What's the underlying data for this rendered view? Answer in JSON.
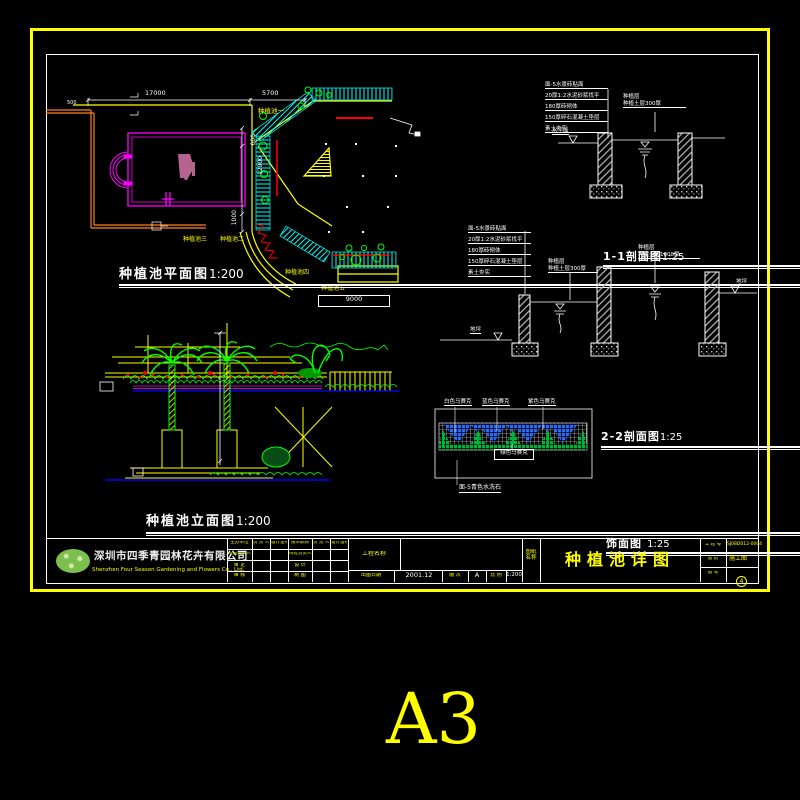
{
  "paper_size": "A3",
  "sheet": {
    "plan": {
      "title": "种植池平面图",
      "scale": "1:200",
      "dim_17000": "17000",
      "dim_5700": "5700",
      "dim_500": "500",
      "dim_600": "600",
      "dim_12900": "12900",
      "dim_1000": "1000",
      "dim_9000": "9000",
      "pool1": "种植池一",
      "pool2": "种植池二",
      "pool3": "种植池三",
      "pool4": "种植池四",
      "pool5": "种植池五"
    },
    "elevation": {
      "title": "种植池立面图",
      "scale": "1:200"
    },
    "section11": {
      "title": "1-1剖面图",
      "scale": "1:25",
      "callout1": "面-5水景砖贴面",
      "callout2": "20厚1:2水泥砂浆找平",
      "callout3": "180厚砖砌体",
      "callout4": "150厚碎石混凝土垫层",
      "callout5": "素土夯实",
      "soil_label1": "种植层",
      "soil_label2": "种植土层300厚",
      "level_label": "水平面"
    },
    "section22": {
      "title": "2-2剖面图",
      "scale": "1:25",
      "callout1": "面-5水景砖贴面",
      "callout2": "20厚1:2水泥砂浆找平",
      "callout3": "180厚砖砌体",
      "callout4": "150厚碎石混凝土垫层",
      "callout5": "素土夯实",
      "soil1_label1": "种植层",
      "soil1_label2": "种植土层300厚",
      "soil2_label1": "种植层",
      "soil2_label2": "种植土层1000厚",
      "ground_right": "地坪",
      "ground_left": "地坪"
    },
    "facing": {
      "title": "饰面图",
      "scale": "1:25",
      "mosaic_white": "白色马赛克",
      "mosaic_blue": "蓝色马赛克",
      "mosaic_purple": "紫色马赛克",
      "mosaic_green": "绿色马赛克",
      "base": "面-5青色水洗石"
    }
  },
  "titleblock": {
    "company_cn": "深圳市四季青园林花卉有限公司",
    "company_en": "Shenzhen Four Season Gardening and Flowers Co., Ltd.",
    "h_unit": "主办单位",
    "h_person": "负 责 人",
    "h_cert": "设计证号",
    "h_tech": "技术职称",
    "h_person2": "负 责 人",
    "h_cert2": "设计证号",
    "r2c1": "项目负责人",
    "r2c4": "绿化负责人",
    "r3c1": "审 定",
    "r3c4": "设 计",
    "r4c1": "审 核",
    "r4c4": "制 图",
    "project_name_label": "工程名称",
    "date_label": "出图日期",
    "date_value": "2001.12",
    "rev_label": "版 次",
    "rev_value": "A",
    "scale_label": "比 例",
    "scale_value": "1:200",
    "sheet_name_label": "图纸名称",
    "sheet_name": "种植池详图",
    "pno_label": "工 程 号",
    "pno_value": "SJ08D012-0004",
    "type_label": "图 别",
    "type_value": "施工图",
    "no_label": "图 号",
    "no_value": "4"
  },
  "colors": {
    "accent": "#ffff00",
    "line": "#ffffff",
    "magenta": "#ff00ff",
    "cyan": "#00ffff",
    "green": "#00ff00",
    "red": "#ff0000",
    "orange": "#ff7f1e",
    "blue": "#0000ff"
  }
}
